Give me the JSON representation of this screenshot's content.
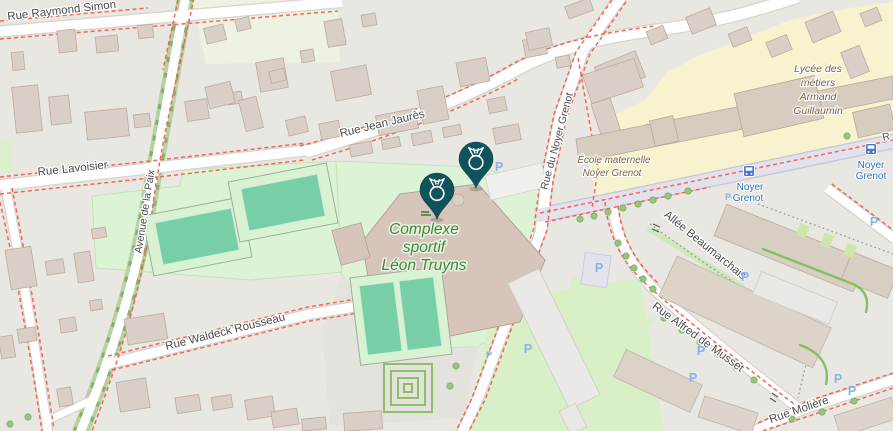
{
  "map_labels": {
    "streets": {
      "raymond_simon": "Rue Raymond Simon",
      "lavoisier": "Rue Lavoisier",
      "avenue_de_la_paix": "Avenue de la Paix",
      "jean_jaures": "Rue Jean Jaurès",
      "rue_du_noyer_grenot": "Rue du Noyer Grenot",
      "waldeck_rousseau": "Rue Waldeck Rousseau",
      "allee_beaumarchais": "Allée Beaumarchais",
      "alfred_de_musset": "Rue Alfred de Musset",
      "moliere": "Rue Molière",
      "right_edge_partial": "R"
    },
    "pois": {
      "complexe_sportif": {
        "lines": [
          "Complexe",
          "sportif",
          "Léon Truyns"
        ]
      },
      "ecole_maternelle": {
        "lines": [
          "École maternelle",
          "Noyer Grenot"
        ]
      },
      "lycee": {
        "lines": [
          "Lycée des",
          "métiers",
          "Armand",
          "Guillaumin"
        ]
      }
    },
    "transit": {
      "stops": [
        {
          "name": "Noyer Grenot",
          "lines": [
            "Noyer",
            "Grenot"
          ]
        },
        {
          "name": "Noyer Grenot",
          "lines": [
            "Noyer",
            "Grenot"
          ]
        }
      ]
    },
    "symbols": {
      "parking": "P"
    },
    "markers": [
      {
        "icon": "medal-pin",
        "color": "#0f535c"
      },
      {
        "icon": "medal-pin",
        "color": "#0f535c"
      }
    ],
    "colors": {
      "pin_teal": "#0f535c",
      "sports_area_green": "#dcf3d6",
      "pitch_green": "#79cfa5",
      "school_area_cream": "#f7f3cf",
      "bus_label_blue": "#2a6fc4",
      "parking_blue": "#86b3e7",
      "poi_label_green": "#478140",
      "poi_label_brown": "#74603e",
      "boundary_dash_red": "#f45a4b",
      "tree_row_green": "#85ad6d"
    }
  }
}
